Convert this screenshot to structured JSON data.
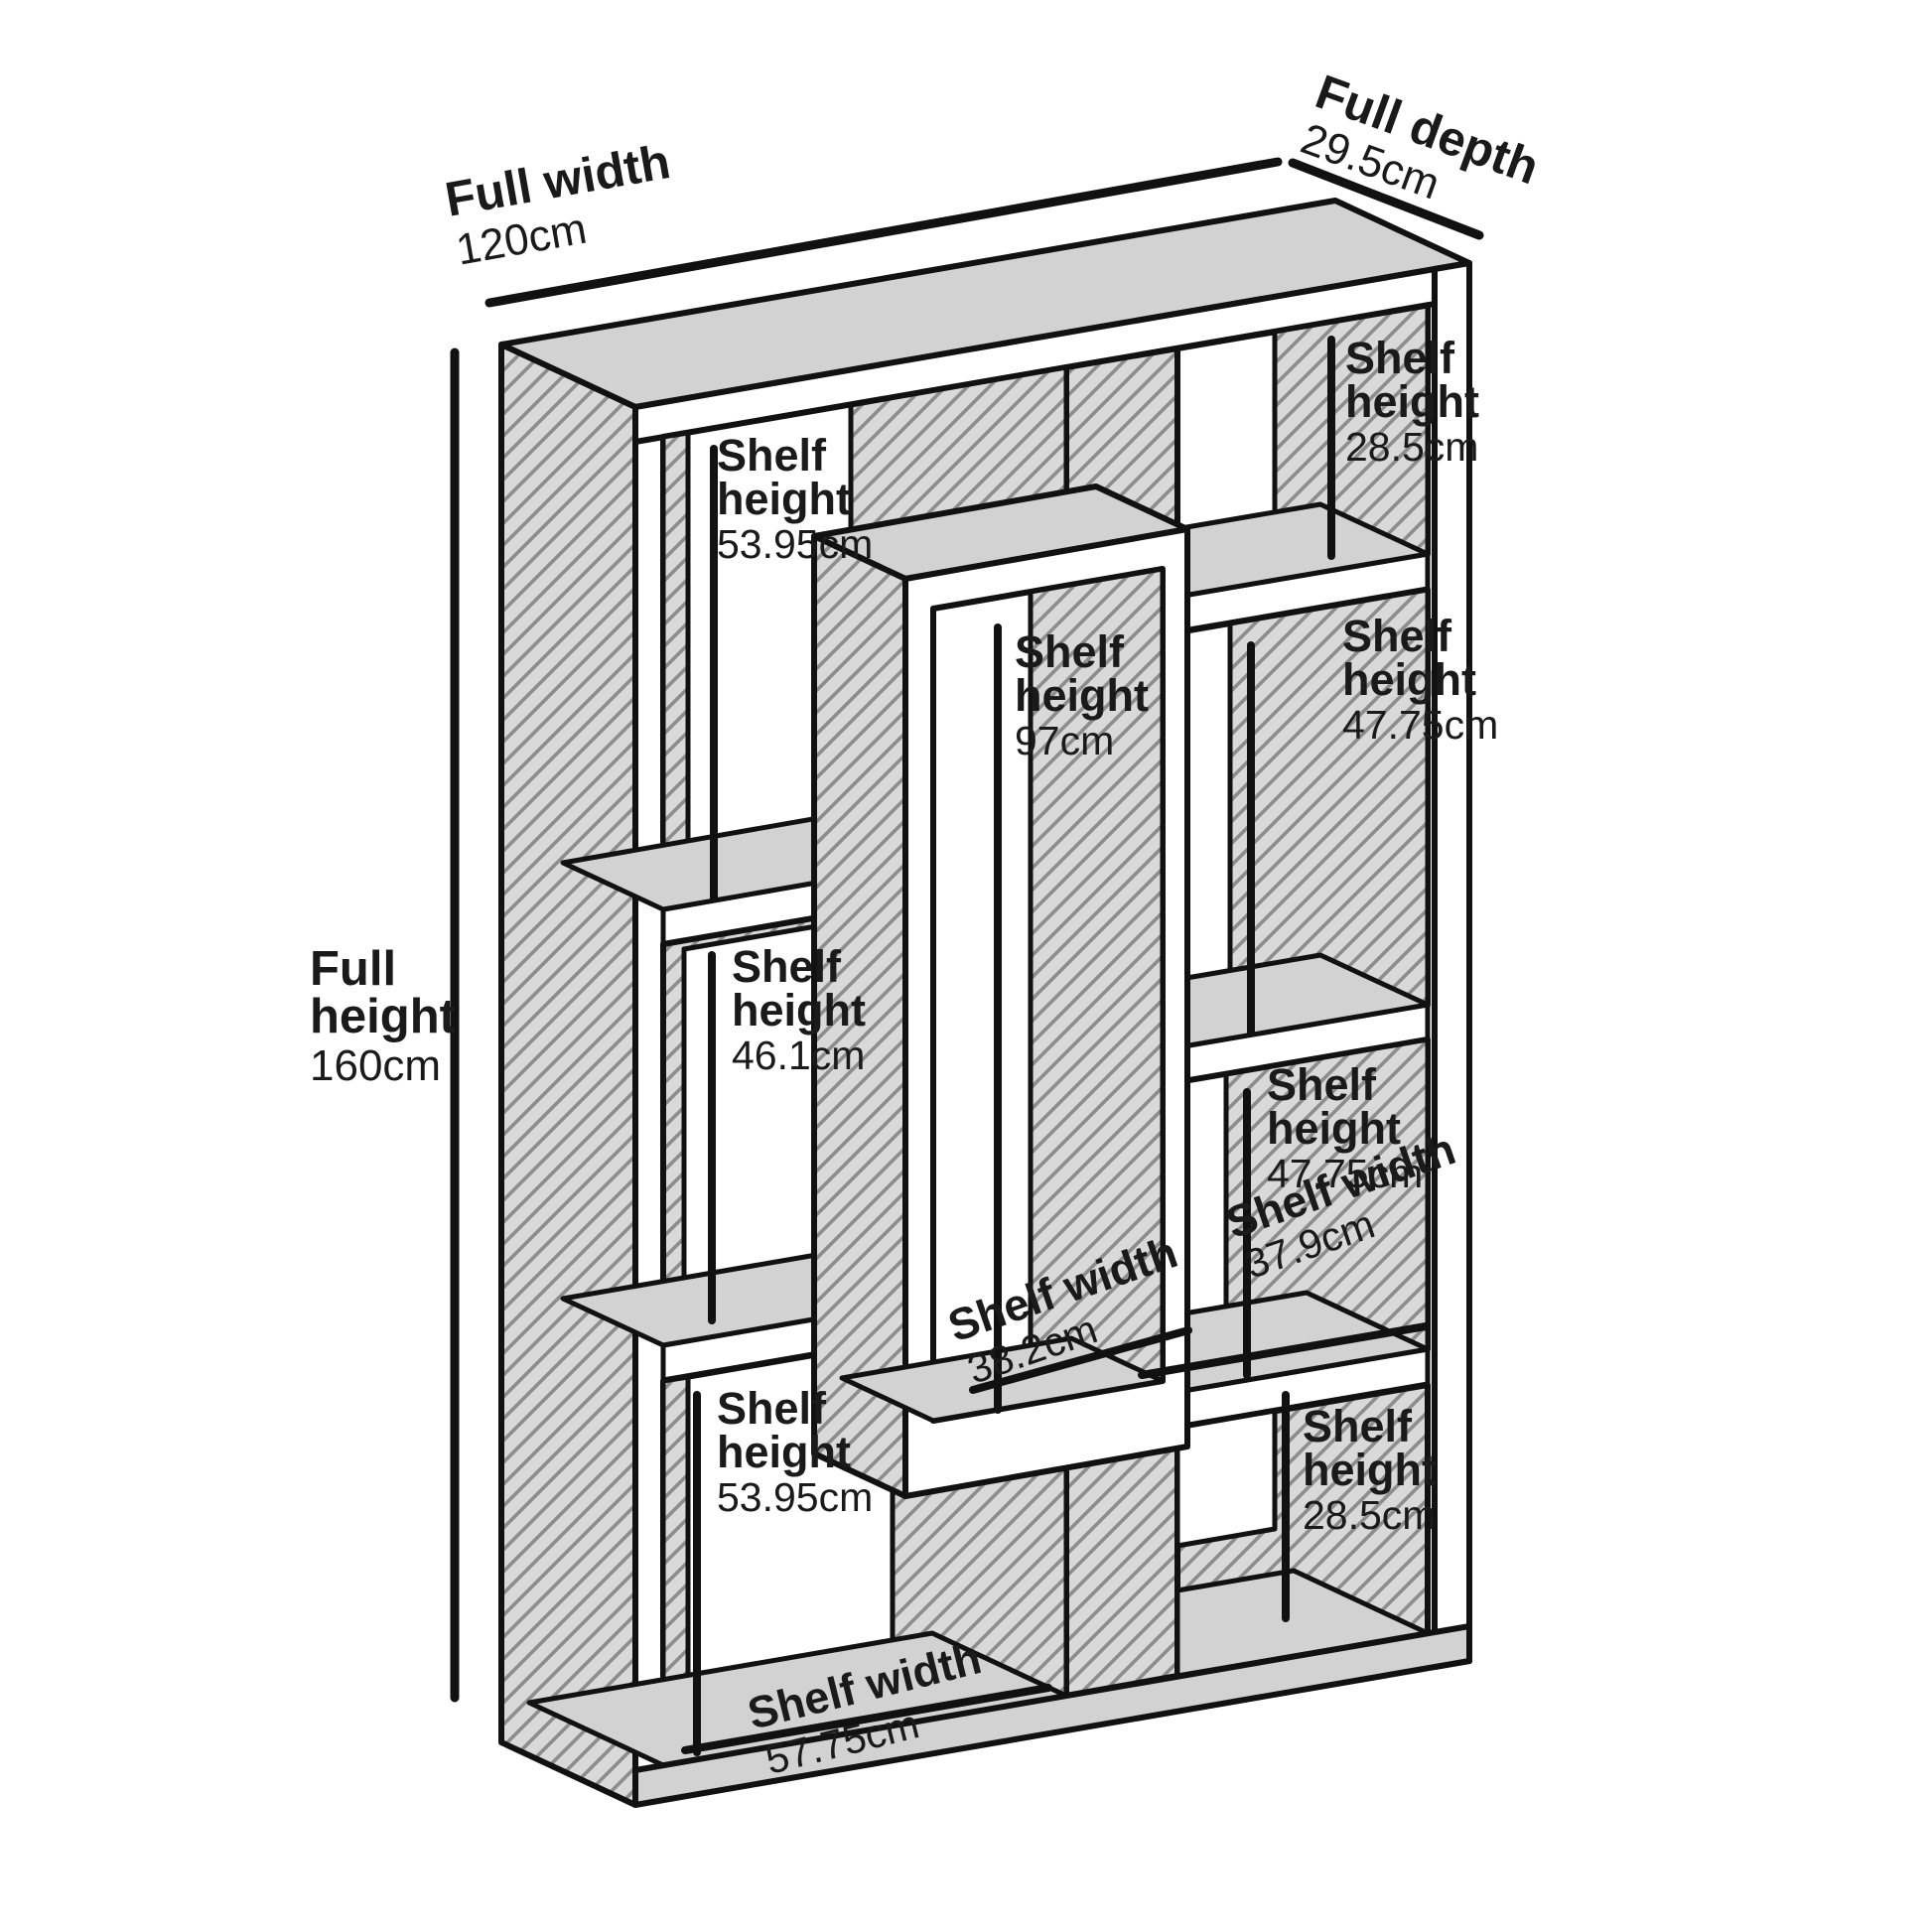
{
  "dimensions": {
    "full_width": {
      "label": "Full width",
      "value": "120cm"
    },
    "full_depth": {
      "label": "Full depth",
      "value": "29.5cm"
    },
    "full_height": {
      "label_line1": "Full",
      "label_line2": "height",
      "value": "160cm"
    }
  },
  "cells": [
    {
      "id": "top-left-cell",
      "line1": "Shelf",
      "line2": "height",
      "value": "53.95cm"
    },
    {
      "id": "top-right-cell",
      "line1": "Shelf",
      "line2": "height",
      "value": "28.5cm"
    },
    {
      "id": "middle-cell",
      "line1": "Shelf",
      "line2": "height",
      "value": "97cm"
    },
    {
      "id": "right-upper-cell",
      "line1": "Shelf",
      "line2": "height",
      "value": "47.75cm"
    },
    {
      "id": "left-middle-cell",
      "line1": "Shelf",
      "line2": "height",
      "value": "46.1cm"
    },
    {
      "id": "right-lower-cell",
      "line1": "Shelf",
      "line2": "height",
      "value": "47.75cm"
    },
    {
      "id": "right-shelf",
      "line1": "Shelf width",
      "value": "37.9cm"
    },
    {
      "id": "middle-shelf",
      "line1": "Shelf width",
      "value": "38.2cm"
    },
    {
      "id": "bottom-left-cell",
      "line1": "Shelf",
      "line2": "height",
      "value": "53.95cm"
    },
    {
      "id": "bottom-right-cell",
      "line1": "Shelf",
      "line2": "height",
      "value": "28.5cm"
    },
    {
      "id": "bottom-shelf",
      "line1": "Shelf width",
      "value": "57.75cm"
    }
  ]
}
